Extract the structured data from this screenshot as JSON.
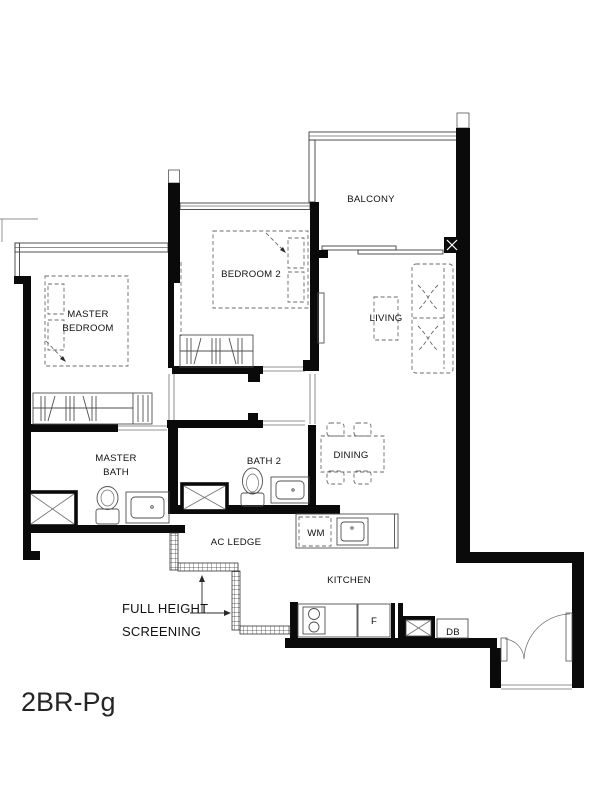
{
  "plan": {
    "title": "2BR-Pg",
    "rooms": {
      "balcony": "BALCONY",
      "bedroom2": "BEDROOM 2",
      "master_bedroom": {
        "line1": "MASTER",
        "line2": "BEDROOM"
      },
      "living": "LIVING",
      "master_bath": {
        "line1": "MASTER",
        "line2": "BATH"
      },
      "bath2": "BATH 2",
      "dining": "DINING",
      "ac_ledge": "AC LEDGE",
      "kitchen": "KITCHEN"
    },
    "fixtures": {
      "washing_machine": "WM",
      "fridge": "F",
      "distribution_board": "DB"
    },
    "notes": {
      "screening": {
        "line1": "FULL HEIGHT",
        "line2": "SCREENING"
      }
    },
    "colors": {
      "wall": "#0a0a0a",
      "furniture_line": "#4f4f4f",
      "background": "#ffffff",
      "text": "#111111"
    }
  }
}
